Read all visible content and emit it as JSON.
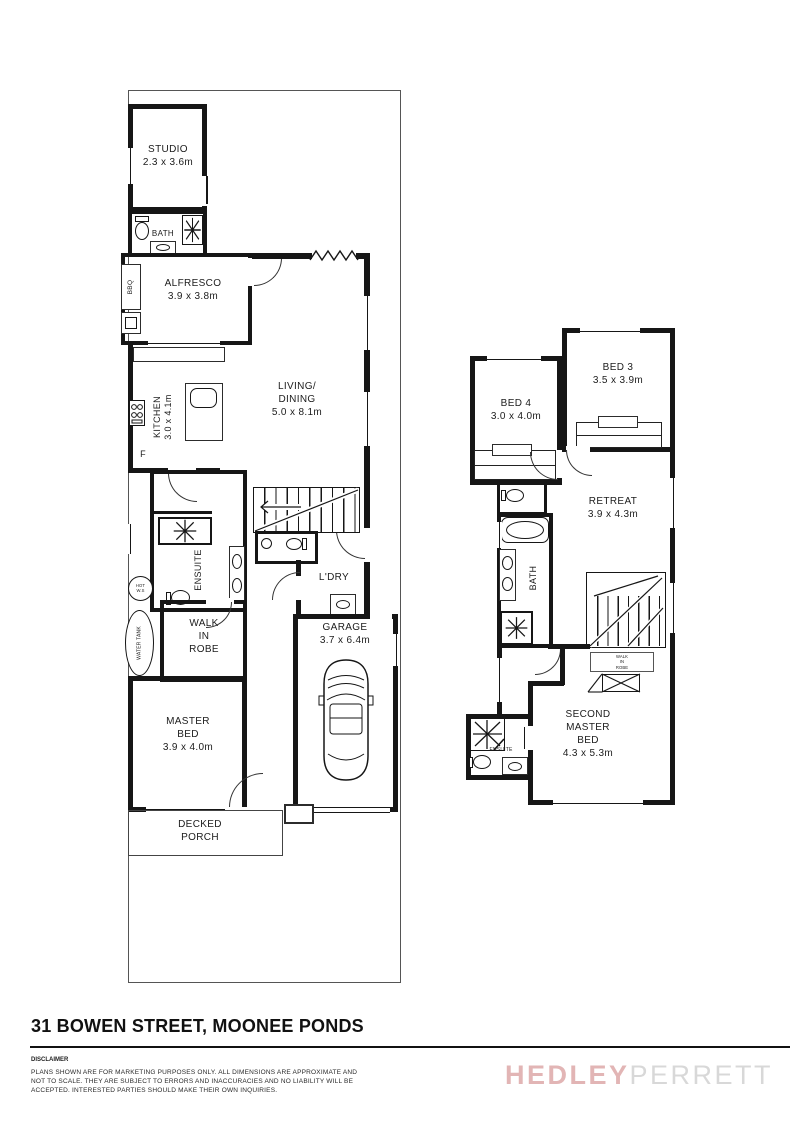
{
  "title_block": {
    "address": "31 BOWEN STREET, MOONEE PONDS",
    "disclaimer_heading": "DISCLAIMER",
    "disclaimer_line1": "PLANS SHOWN ARE FOR MARKETING PURPOSES ONLY. ALL DIMENSIONS ARE APPROXIMATE AND",
    "disclaimer_line2": "NOT TO SCALE. THEY ARE SUBJECT TO ERRORS AND INACCURACIES AND NO LIABILITY WILL BE",
    "disclaimer_line3": "ACCEPTED. INTERESTED PARTIES SHOULD MAKE THEIR OWN INQUIRIES.",
    "logo_hedley": "HEDLEY",
    "logo_perrett": "PERRETT",
    "logo_hedley_color": "#e2b5b5",
    "logo_perrett_color": "#d8d8d8",
    "line_color": "#161616"
  },
  "ground_floor": {
    "studio_label": "STUDIO",
    "studio_dims": "2.3 x 3.6m",
    "bath_label": "BATH",
    "bbq_label": "BBQ",
    "alfresco_label": "ALFRESCO",
    "alfresco_dims": "3.9 x 3.8m",
    "kitchen_label": "KITCHEN",
    "kitchen_dims": "3.0 x 4.1m",
    "fridge_label": "F",
    "living_line1": "LIVING/",
    "living_line2": "DINING",
    "living_dims": "5.0 x 8.1m",
    "ensuite_label": "ENSUITE",
    "hot_water_line1": "HOT",
    "hot_water_line2": "W.S",
    "water_tank_label": "WATER TANK",
    "wir_line1": "WALK",
    "wir_line2": "IN",
    "wir_line3": "ROBE",
    "master_line1": "MASTER",
    "master_line2": "BED",
    "master_dims": "3.9 x 4.0m",
    "laundry_label": "L'DRY",
    "garage_label": "GARAGE",
    "garage_dims": "3.7 x 6.4m",
    "porch_line1": "DECKED",
    "porch_line2": "PORCH"
  },
  "first_floor": {
    "bed4_label": "BED 4",
    "bed4_dims": "3.0 x 4.0m",
    "bed3_label": "BED 3",
    "bed3_dims": "3.5 x 3.9m",
    "retreat_label": "RETREAT",
    "retreat_dims": "3.9 x 4.3m",
    "bath_label": "BATH",
    "wir_line1": "WALK",
    "wir_line2": "IN",
    "wir_line3": "ROBE",
    "sm_line1": "SECOND",
    "sm_line2": "MASTER",
    "sm_line3": "BED",
    "sm_dims": "4.3 x 5.3m",
    "ensuite_label": "ENSUITE"
  }
}
